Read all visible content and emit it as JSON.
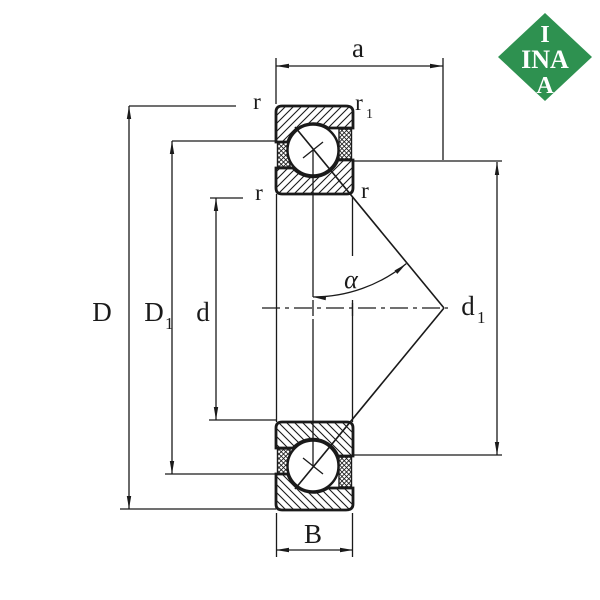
{
  "background": "#ffffff",
  "line_color": "#1a1a1a",
  "logo": {
    "green": "#2E9150",
    "text_color": "#ffffff",
    "row1": "I",
    "row2": "INA",
    "row3": "A"
  },
  "dims": {
    "a": {
      "base": "a",
      "sub": ""
    },
    "D": {
      "base": "D",
      "sub": ""
    },
    "D1": {
      "base": "D",
      "sub": "1"
    },
    "d": {
      "base": "d",
      "sub": ""
    },
    "d1": {
      "base": "d",
      "sub": "1"
    },
    "B": {
      "base": "B",
      "sub": ""
    },
    "alpha": {
      "base": "α",
      "sub": ""
    },
    "r_top_left": {
      "base": "r",
      "sub": ""
    },
    "r1_top_right": {
      "base": "r",
      "sub": "1"
    },
    "r_mid_left": {
      "base": "r",
      "sub": ""
    },
    "r_mid_right": {
      "base": "r",
      "sub": ""
    }
  }
}
